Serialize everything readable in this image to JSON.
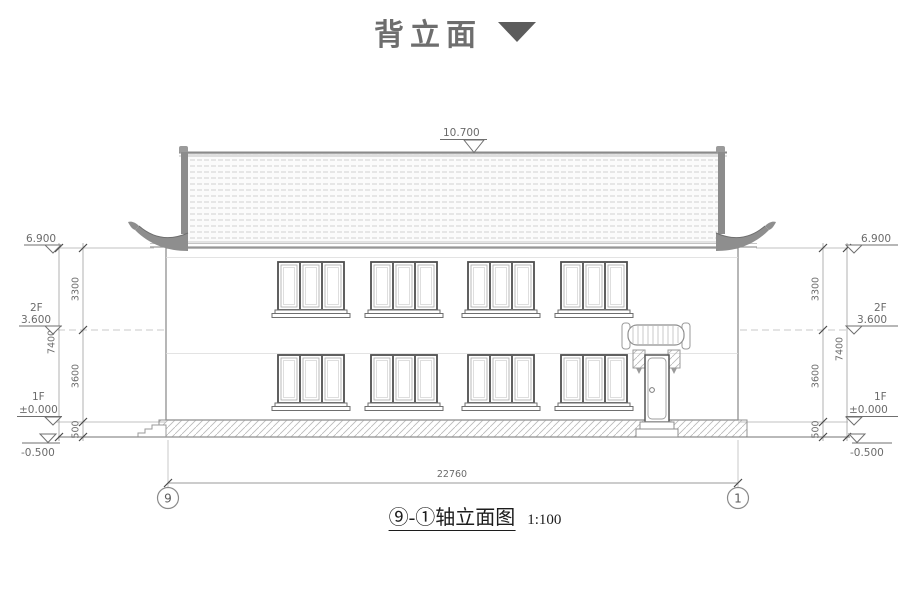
{
  "title": {
    "text": "背立面"
  },
  "levels": {
    "ridge": "10.700",
    "eave": "6.900",
    "f2_label": "2F",
    "f2": "3.600",
    "f1_label": "1F",
    "f1": "±0.000",
    "ground": "-0.500"
  },
  "dims": {
    "floor2_height": "3300",
    "floor1_height": "3600",
    "plinth": "500",
    "total_height": "7400",
    "total_width": "22760"
  },
  "axes": {
    "left": "9",
    "right": "1"
  },
  "caption": {
    "text": "⑨-①轴立面图",
    "scale": "1:100"
  }
}
